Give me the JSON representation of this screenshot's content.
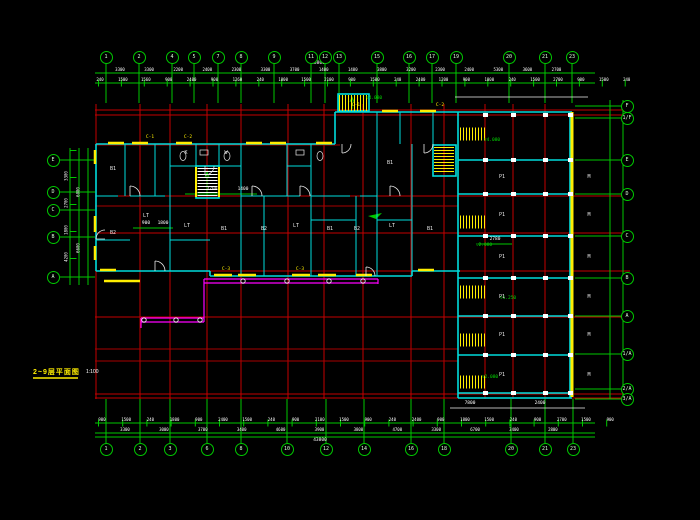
{
  "title": {
    "text": "2~9层平面图",
    "scale": "1:100"
  },
  "colors": {
    "background": "#000000",
    "grid": "#c40000",
    "axis": "#00c800",
    "wall": "#00dcdc",
    "dim_text": "#ffffff",
    "hatch": "#ffee00",
    "balcony": "#ff00ff"
  },
  "bubbles": {
    "top": {
      "y": 57,
      "items": [
        {
          "x": 106,
          "l": "1"
        },
        {
          "x": 139,
          "l": "2"
        },
        {
          "x": 172,
          "l": "4"
        },
        {
          "x": 194,
          "l": "5"
        },
        {
          "x": 218,
          "l": "7"
        },
        {
          "x": 241,
          "l": "8"
        },
        {
          "x": 274,
          "l": "9"
        },
        {
          "x": 311,
          "l": "11"
        },
        {
          "x": 325,
          "l": "12"
        },
        {
          "x": 339,
          "l": "13"
        },
        {
          "x": 377,
          "l": "15"
        },
        {
          "x": 409,
          "l": "16"
        },
        {
          "x": 432,
          "l": "17"
        },
        {
          "x": 456,
          "l": "19"
        },
        {
          "x": 509,
          "l": "20"
        },
        {
          "x": 545,
          "l": "21"
        },
        {
          "x": 572,
          "l": "23"
        }
      ]
    },
    "bottom": {
      "y": 449,
      "items": [
        {
          "x": 106,
          "l": "1"
        },
        {
          "x": 140,
          "l": "2"
        },
        {
          "x": 170,
          "l": "3"
        },
        {
          "x": 207,
          "l": "6"
        },
        {
          "x": 241,
          "l": "8"
        },
        {
          "x": 287,
          "l": "10"
        },
        {
          "x": 326,
          "l": "12"
        },
        {
          "x": 364,
          "l": "14"
        },
        {
          "x": 411,
          "l": "16"
        },
        {
          "x": 444,
          "l": "18"
        },
        {
          "x": 511,
          "l": "20"
        },
        {
          "x": 545,
          "l": "21"
        },
        {
          "x": 573,
          "l": "23"
        }
      ]
    },
    "left": {
      "x": 53,
      "items": [
        {
          "y": 160,
          "l": "E"
        },
        {
          "y": 192,
          "l": "D"
        },
        {
          "y": 210,
          "l": "C"
        },
        {
          "y": 237,
          "l": "B"
        },
        {
          "y": 277,
          "l": "A"
        }
      ]
    },
    "right": {
      "x": 627,
      "items": [
        {
          "y": 106,
          "l": "F"
        },
        {
          "y": 118,
          "l": "1/F"
        },
        {
          "y": 160,
          "l": "E"
        },
        {
          "y": 194,
          "l": "D"
        },
        {
          "y": 236,
          "l": "C"
        },
        {
          "y": 278,
          "l": "B"
        },
        {
          "y": 316,
          "l": "A"
        },
        {
          "y": 354,
          "l": "1/A"
        },
        {
          "y": 389,
          "l": "2/A"
        },
        {
          "y": 399,
          "l": "3/A"
        }
      ]
    }
  },
  "dim_rows": [
    {
      "dir": "h",
      "y": 67,
      "x0": 120,
      "step": 29.1,
      "values": [
        "3300",
        "3300",
        "2200",
        "2400",
        "2300",
        "3300",
        "3700",
        "1400",
        "1400",
        "3800",
        "3200",
        "2300",
        "2400",
        "5300",
        "3600",
        "2700"
      ]
    },
    {
      "dir": "h",
      "y": 77,
      "x0": 100,
      "step": 22.9,
      "values": [
        "240",
        "1500",
        "1560",
        "900",
        "2400",
        "900",
        "1260",
        "240",
        "1800",
        "1500",
        "2100",
        "900",
        "1500",
        "240",
        "2400",
        "1200",
        "900",
        "1800",
        "240",
        "1500",
        "2700",
        "900",
        "1500",
        "240"
      ]
    },
    {
      "dir": "h",
      "y": 417,
      "x0": 102,
      "step": 24.2,
      "values": [
        "900",
        "1500",
        "240",
        "1800",
        "900",
        "2400",
        "1500",
        "240",
        "900",
        "2100",
        "1500",
        "900",
        "240",
        "2400",
        "900",
        "1800",
        "1500",
        "240",
        "900",
        "2700",
        "1500",
        "900"
      ]
    },
    {
      "dir": "h",
      "y": 427,
      "x0": 125,
      "step": 38.9,
      "values": [
        "3300",
        "3000",
        "3700",
        "3400",
        "4600",
        "3900",
        "3800",
        "4700",
        "3300",
        "6700",
        "3400",
        "2800"
      ]
    },
    {
      "dir": "v",
      "x": 66,
      "y0": 176,
      "step": 27,
      "values": [
        "3300",
        "2700",
        "1800",
        "4200"
      ]
    },
    {
      "dir": "v",
      "x": 78,
      "y0": 192,
      "step": 56,
      "values": [
        "6000",
        "6600"
      ]
    }
  ],
  "free_texts": [
    {
      "x": 318,
      "y": 61,
      "v": "46800",
      "c": "w"
    },
    {
      "x": 320,
      "y": 438,
      "v": "43800",
      "c": "w"
    },
    {
      "x": 374,
      "y": 96,
      "v": "▽4.080",
      "c": "g"
    },
    {
      "x": 492,
      "y": 138,
      "v": "▽4.080",
      "c": "g"
    },
    {
      "x": 484,
      "y": 243,
      "v": "▽2.080",
      "c": "g"
    },
    {
      "x": 490,
      "y": 375,
      "v": "▽2.080",
      "c": "g"
    },
    {
      "x": 508,
      "y": 296,
      "v": "▽1.250",
      "c": "g"
    },
    {
      "x": 150,
      "y": 135,
      "v": "C-1",
      "c": "y"
    },
    {
      "x": 188,
      "y": 135,
      "v": "C-2",
      "c": "y"
    },
    {
      "x": 356,
      "y": 103,
      "v": "C-1",
      "c": "y"
    },
    {
      "x": 440,
      "y": 103,
      "v": "C-2",
      "c": "y"
    },
    {
      "x": 226,
      "y": 267,
      "v": "C-3",
      "c": "y"
    },
    {
      "x": 300,
      "y": 267,
      "v": "C-3",
      "c": "y"
    },
    {
      "x": 212,
      "y": 187,
      "v": "2700",
      "c": "w"
    },
    {
      "x": 243,
      "y": 187,
      "v": "1400",
      "c": "w"
    },
    {
      "x": 146,
      "y": 221,
      "v": "900",
      "c": "w"
    },
    {
      "x": 163,
      "y": 221,
      "v": "1800",
      "c": "w"
    },
    {
      "x": 495,
      "y": 237,
      "v": "2780",
      "c": "w"
    },
    {
      "x": 470,
      "y": 401,
      "v": "7800",
      "c": "w"
    },
    {
      "x": 540,
      "y": 401,
      "v": "2400",
      "c": "w"
    },
    {
      "x": 113,
      "y": 166,
      "v": "B1",
      "c": "r"
    },
    {
      "x": 113,
      "y": 230,
      "v": "B2",
      "c": "r"
    },
    {
      "x": 146,
      "y": 213,
      "v": "LT",
      "c": "r"
    },
    {
      "x": 186,
      "y": 150,
      "v": "K",
      "c": "r"
    },
    {
      "x": 226,
      "y": 150,
      "v": "W",
      "c": "r"
    },
    {
      "x": 187,
      "y": 223,
      "v": "LT",
      "c": "r"
    },
    {
      "x": 224,
      "y": 226,
      "v": "B1",
      "c": "r"
    },
    {
      "x": 264,
      "y": 226,
      "v": "B2",
      "c": "r"
    },
    {
      "x": 296,
      "y": 223,
      "v": "LT",
      "c": "r"
    },
    {
      "x": 330,
      "y": 226,
      "v": "B1",
      "c": "r"
    },
    {
      "x": 357,
      "y": 226,
      "v": "B2",
      "c": "r"
    },
    {
      "x": 390,
      "y": 160,
      "v": "B1",
      "c": "r"
    },
    {
      "x": 392,
      "y": 223,
      "v": "LT",
      "c": "r"
    },
    {
      "x": 430,
      "y": 226,
      "v": "B1",
      "c": "r"
    },
    {
      "x": 502,
      "y": 174,
      "v": "P1",
      "c": "r"
    },
    {
      "x": 502,
      "y": 212,
      "v": "P1",
      "c": "r"
    },
    {
      "x": 502,
      "y": 254,
      "v": "P1",
      "c": "r"
    },
    {
      "x": 502,
      "y": 294,
      "v": "P1",
      "c": "r"
    },
    {
      "x": 502,
      "y": 332,
      "v": "P1",
      "c": "r"
    },
    {
      "x": 502,
      "y": 372,
      "v": "P1",
      "c": "r"
    },
    {
      "x": 589,
      "y": 174,
      "v": "M",
      "c": "r"
    },
    {
      "x": 589,
      "y": 212,
      "v": "M",
      "c": "r"
    },
    {
      "x": 589,
      "y": 254,
      "v": "M",
      "c": "r"
    },
    {
      "x": 589,
      "y": 294,
      "v": "M",
      "c": "r"
    },
    {
      "x": 589,
      "y": 332,
      "v": "M",
      "c": "r"
    },
    {
      "x": 589,
      "y": 372,
      "v": "M",
      "c": "r"
    }
  ],
  "wing_columns": {
    "xs": [
      485,
      513,
      545,
      570
    ],
    "ys": [
      115,
      160,
      194,
      236,
      278,
      316,
      355,
      393
    ]
  }
}
